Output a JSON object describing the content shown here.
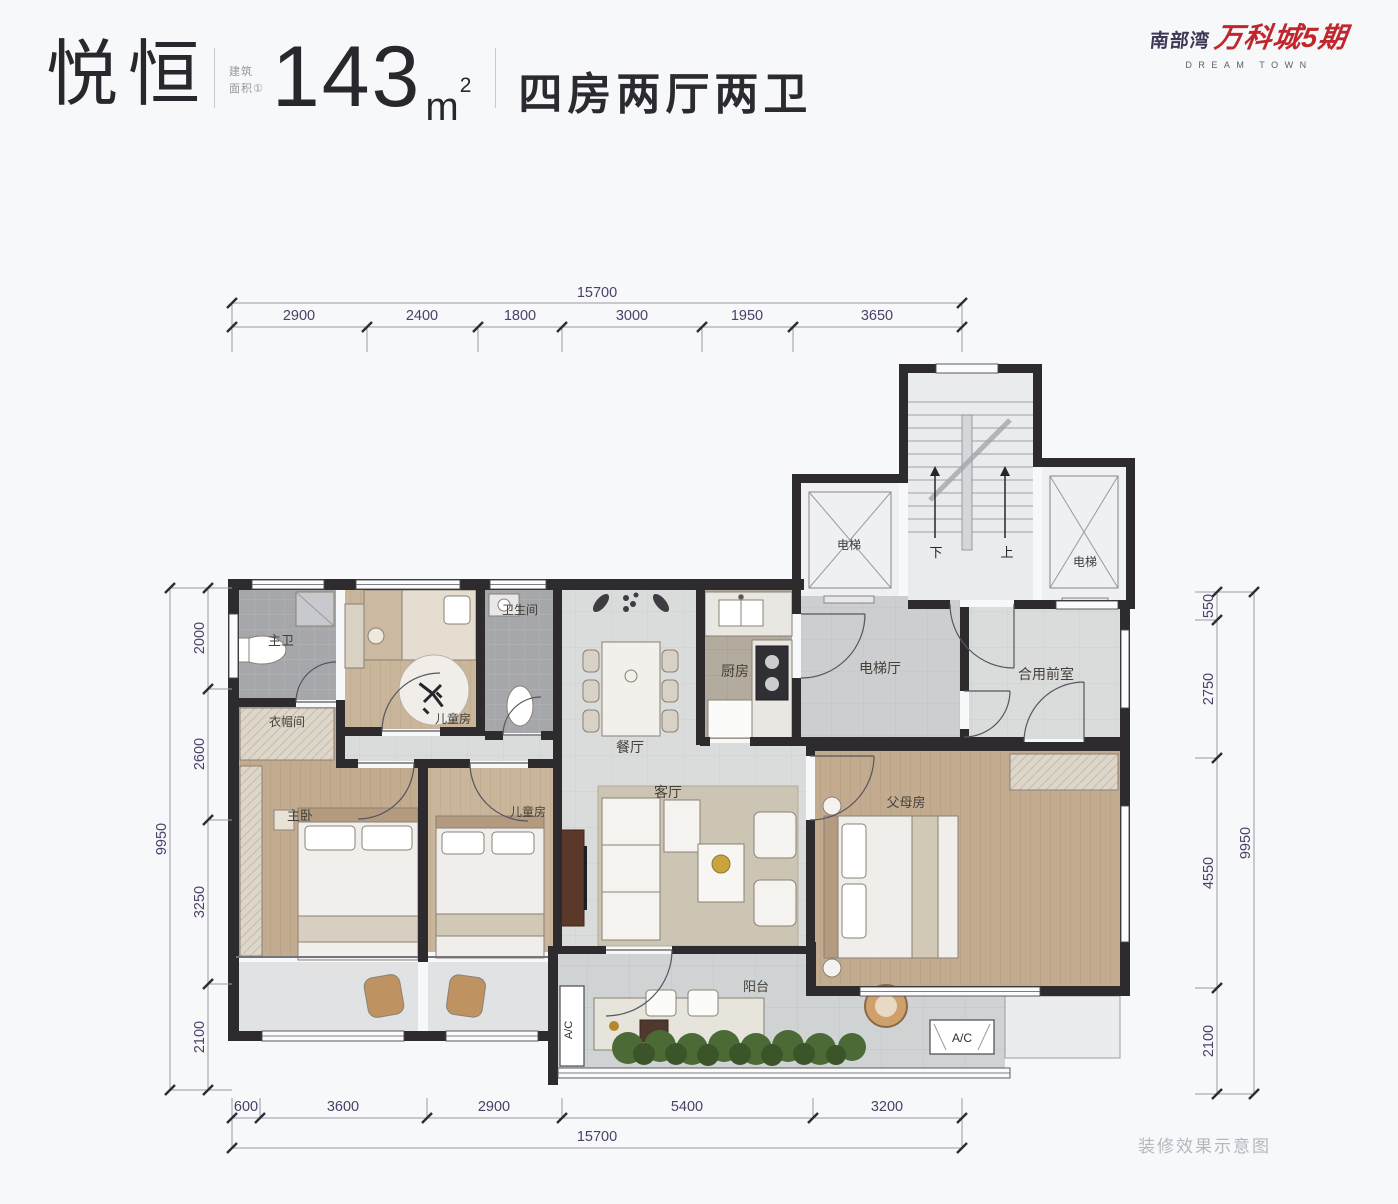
{
  "header": {
    "unit_name": "悦恒",
    "area_label": "建筑\n面积①",
    "area_value": "143",
    "area_unit": "m",
    "area_exponent": "2",
    "layout_text": "四房两厅两卫"
  },
  "logo": {
    "prefix": "南部湾",
    "name": "万科城5期",
    "subtitle": "DREAM TOWN"
  },
  "plan": {
    "rooms": {
      "master_bath": "主卫",
      "cloakroom": "衣帽间",
      "child_room_top": "儿童房",
      "bathroom": "卫生间",
      "dining_room": "餐厅",
      "kitchen": "厨房",
      "elevator_hall": "电梯厅",
      "shared_front_room": "合用前室",
      "master_bedroom": "主卧",
      "child_room_2": "儿童房",
      "living_room": "客厅",
      "parents_room": "父母房",
      "balcony": "阳台",
      "elevator_left": "电梯",
      "elevator_right": "电梯",
      "stairs_down": "下",
      "stairs_up": "上",
      "ac_left": "A/C",
      "ac_right": "A/C"
    },
    "dimensions": {
      "top": {
        "total": "15700",
        "segments": [
          "2900",
          "2400",
          "1800",
          "3000",
          "1950",
          "3650"
        ]
      },
      "bottom": {
        "total": "15700",
        "segments": [
          "600",
          "3600",
          "2900",
          "5400",
          "3200"
        ]
      },
      "left": {
        "total": "9950",
        "segments": [
          "2000",
          "2600",
          "3250",
          "2100"
        ]
      },
      "right": {
        "total": "9950",
        "segments": [
          "550",
          "2750",
          "4550",
          "2100"
        ]
      }
    }
  },
  "footer": {
    "watermark": "装修效果示意图"
  },
  "colors": {
    "brand_red": "#c0262c",
    "dimension_text": "#4b4067",
    "wall": "#2d2b2d"
  }
}
